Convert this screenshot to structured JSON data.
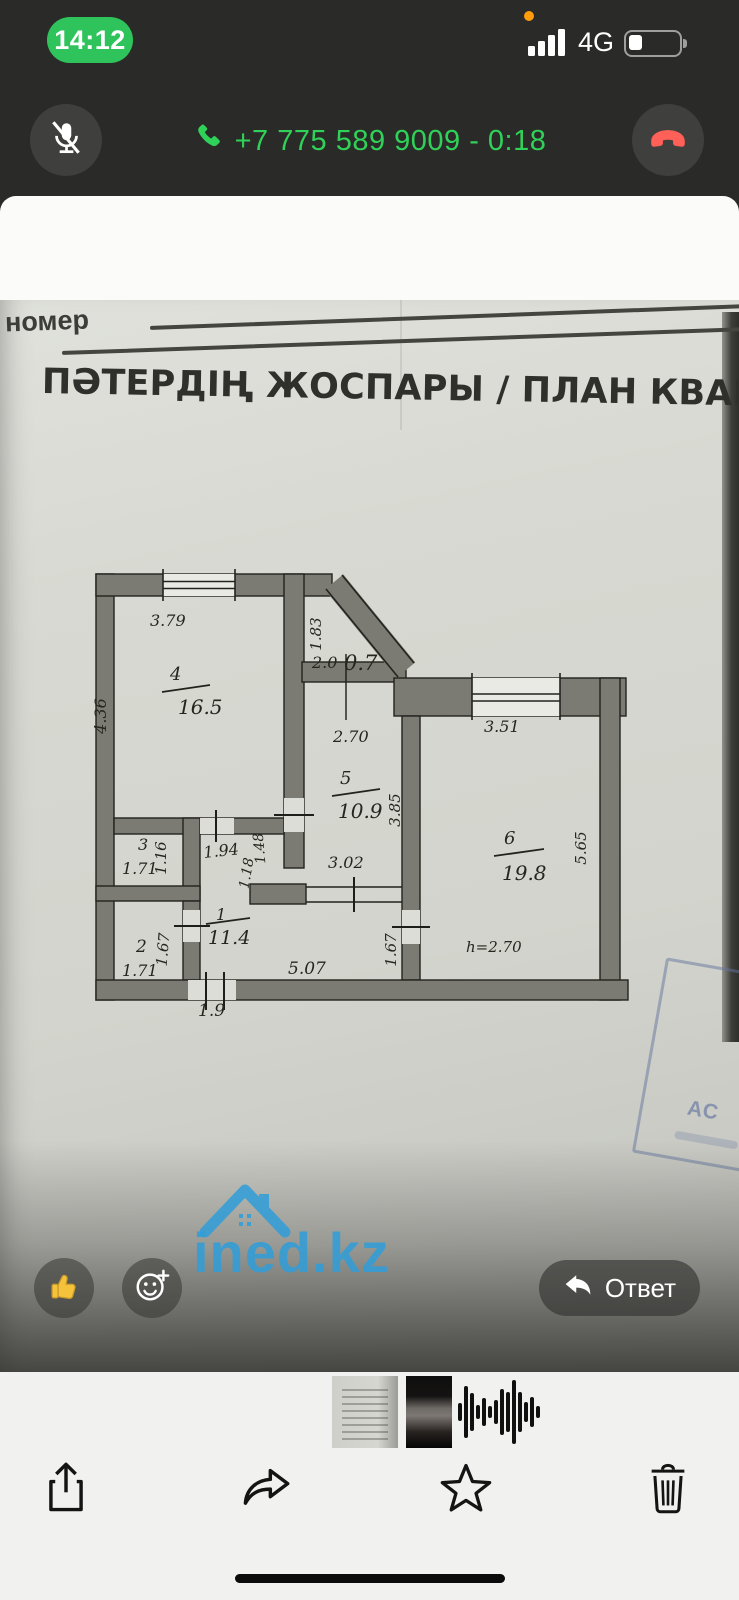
{
  "status_bar": {
    "time": "14:12",
    "network": "4G"
  },
  "call_banner": {
    "label": "+7 775 589 9009 - 0:18",
    "accent_green": "#30d158",
    "end_red": "#ff6057"
  },
  "viewer_header": {
    "title": "Вы",
    "subtitle": "06.11.2025, 22:38"
  },
  "document": {
    "field_label": "номер",
    "title": "ПӘТЕРДІҢ ЖОСПАРЫ / ПЛАН КВАРТИ",
    "stamp_text": "АС",
    "watermark": "ined.kz"
  },
  "plan": {
    "room4": {
      "number": "4",
      "area": "16.5"
    },
    "room5": {
      "number": "5",
      "area": "10.9"
    },
    "room6": {
      "number": "6",
      "area": "19.8"
    },
    "room1": {
      "number": "1",
      "area": "11.4"
    },
    "room3": {
      "number": "3"
    },
    "room2": {
      "number": "2"
    },
    "dims": {
      "d379": "3.79",
      "d436": "4.36",
      "d183": "1.83",
      "d20": "2.0",
      "d07": "0.7",
      "d270": "2.70",
      "d385": "3.85",
      "d302": "3.02",
      "d351": "3.51",
      "d565": "5.65",
      "h": "h=2.70",
      "d171a": "1.71",
      "d116": "1.16",
      "d194": "1.94",
      "d148": "1.48",
      "d118": "1.18",
      "d171b": "1.71",
      "d167a": "1.67",
      "d167b": "1.67",
      "d507": "5.07",
      "d19": "1.9"
    }
  },
  "reactions": {
    "reply_label": "Ответ"
  },
  "thumbnails": {
    "waveform_bars": [
      18,
      52,
      38,
      14,
      28,
      12,
      24,
      46,
      40,
      64,
      40,
      20,
      30,
      12
    ]
  },
  "icons": {
    "mute": "mic-slash",
    "call": "phone",
    "end_call": "phone-down",
    "back": "chevron-left",
    "draw": "scribble",
    "more": "ellipsis",
    "like": "thumbs-up",
    "add_reaction": "smiley-plus",
    "reply": "reply-arrow",
    "share": "share",
    "forward": "forward-arrow",
    "favorite": "star",
    "delete": "trash"
  }
}
